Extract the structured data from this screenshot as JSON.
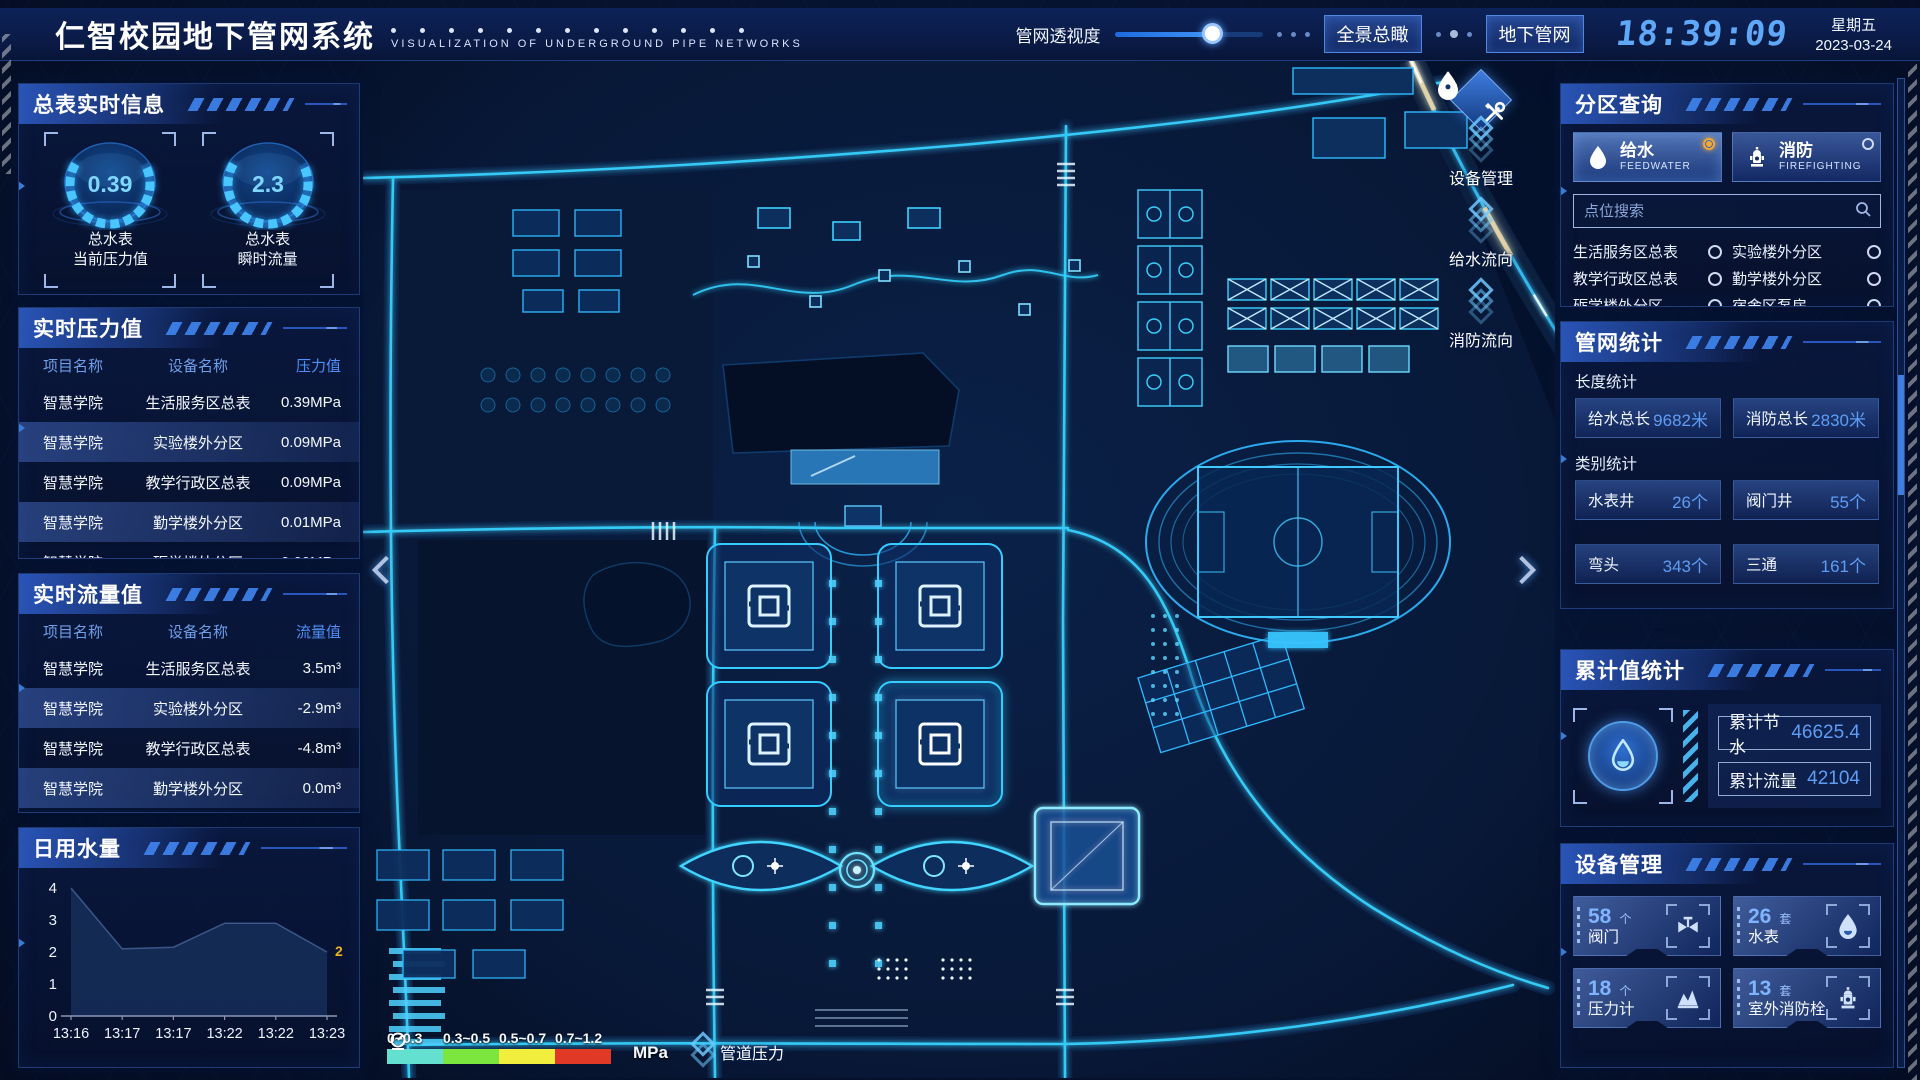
{
  "header": {
    "title": "仁智校园地下管网系统",
    "subtitle": "VISUALIZATION OF UNDERGROUND PIPE NETWORKS",
    "slider_label": "管网透视度",
    "slider_percent": 66,
    "btn_overview": "全景总瞰",
    "btn_underground": "地下管网",
    "time": "18:39:09",
    "weekday": "星期五",
    "date": "2023-03-24"
  },
  "left": {
    "master_meter": {
      "title": "总表实时信息",
      "gauges": [
        {
          "value": "0.39",
          "label1": "总水表",
          "label2": "当前压力值"
        },
        {
          "value": "2.3",
          "label1": "总水表",
          "label2": "瞬时流量"
        }
      ]
    },
    "pressure": {
      "title": "实时压力值",
      "headers": [
        "项目名称",
        "设备名称",
        "压力值"
      ],
      "rows": [
        [
          "智慧学院",
          "生活服务区总表",
          "0.39MPa"
        ],
        [
          "智慧学院",
          "实验楼外分区",
          "0.09MPa"
        ],
        [
          "智慧学院",
          "教学行政区总表",
          "0.09MPa"
        ],
        [
          "智慧学院",
          "勤学楼外分区",
          "0.01MPa"
        ],
        [
          "智慧学院",
          "砺学楼外分区",
          "0.00MPa"
        ]
      ]
    },
    "flow": {
      "title": "实时流量值",
      "headers": [
        "项目名称",
        "设备名称",
        "流量值"
      ],
      "rows": [
        [
          "智慧学院",
          "生活服务区总表",
          "3.5m³"
        ],
        [
          "智慧学院",
          "实验楼外分区",
          "-2.9m³"
        ],
        [
          "智慧学院",
          "教学行政区总表",
          "-4.8m³"
        ],
        [
          "智慧学院",
          "勤学楼外分区",
          "0.0m³"
        ],
        [
          "智慧学院",
          "砺学楼外分区",
          "2.2m³"
        ]
      ]
    },
    "daily_water_title": "日用水量"
  },
  "chart_data": {
    "type": "area",
    "title": "日用水量",
    "x": [
      "13:16",
      "13:17",
      "13:17",
      "13:22",
      "13:22",
      "13:23"
    ],
    "values": [
      4,
      2.1,
      2.15,
      2.9,
      2.9,
      2
    ],
    "end_label": "2",
    "end_label_color": "#e8b42a",
    "yticks": [
      0,
      1,
      2,
      3,
      4
    ],
    "ylim": [
      0,
      4
    ],
    "grid": false,
    "fill_color": "#142b55"
  },
  "map": {
    "toolbar": [
      {
        "icon": "tools-icon",
        "label": "设备管理"
      },
      {
        "icon": "water-drop-icon",
        "label": "给水流向"
      },
      {
        "icon": "hydrant-icon",
        "label": "消防流向"
      }
    ],
    "legend": {
      "ranges": [
        "0~0.3",
        "0.3~0.5",
        "0.5~0.7",
        "0.7~1.2"
      ],
      "colors": [
        "#63e0cf",
        "#7ce63f",
        "#f2ee3e",
        "#e03a26"
      ],
      "unit": "MPa",
      "pipe_pressure_label": "管道压力"
    }
  },
  "right": {
    "zone_query": {
      "title": "分区查询",
      "tabs": [
        {
          "label": "给水",
          "sub": "FEEDWATER",
          "icon": "water-drop-icon",
          "selected": true
        },
        {
          "label": "消防",
          "sub": "FIREFIGHTING",
          "icon": "hydrant-icon",
          "selected": false
        }
      ],
      "search_placeholder": "点位搜索",
      "items": [
        "生活服务区总表",
        "实验楼外分区",
        "教学行政区总表",
        "勤学楼外分区",
        "砺学楼外分区",
        "宿舍区泵房"
      ]
    },
    "pipe_stats": {
      "title": "管网统计",
      "length_title": "长度统计",
      "length_stats": [
        {
          "label": "给水总长",
          "value": "9682米"
        },
        {
          "label": "消防总长",
          "value": "2830米"
        }
      ],
      "category_title": "类别统计",
      "category_stats": [
        {
          "label": "水表井",
          "value": "26个"
        },
        {
          "label": "阀门井",
          "value": "55个"
        },
        {
          "label": "弯头",
          "value": "343个"
        },
        {
          "label": "三通",
          "value": "161个"
        }
      ]
    },
    "cumulative": {
      "title": "累计值统计",
      "stats": [
        {
          "label": "累计节水",
          "value": "46625.4"
        },
        {
          "label": "累计流量",
          "value": "42104"
        }
      ]
    },
    "devices": {
      "title": "设备管理",
      "cards": [
        {
          "count": "58",
          "unit": "个",
          "name": "阀门",
          "icon": "valve-icon"
        },
        {
          "count": "26",
          "unit": "套",
          "name": "水表",
          "icon": "water-meter-icon"
        },
        {
          "count": "18",
          "unit": "个",
          "name": "压力计",
          "icon": "pressure-gauge-icon"
        },
        {
          "count": "13",
          "unit": "套",
          "name": "室外消防栓",
          "icon": "hydrant-icon"
        }
      ]
    }
  }
}
